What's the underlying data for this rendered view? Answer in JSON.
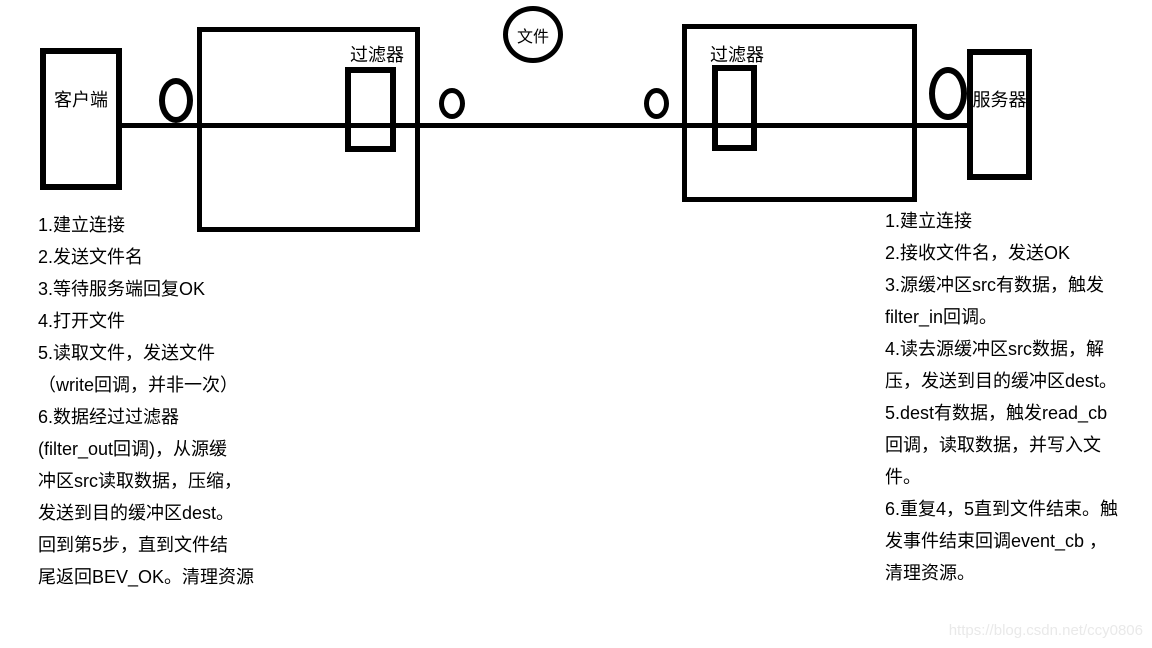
{
  "diagram": {
    "client_label": "客户端",
    "server_label": "服务器",
    "file_label": "文件",
    "filter_left_label": "过滤器",
    "filter_right_label": "过滤器",
    "client_steps": [
      "1.建立连接",
      "2.发送文件名",
      "3.等待服务端回复OK",
      "4.打开文件",
      "5.读取文件，发送文件",
      "（write回调，并非一次）",
      "6.数据经过过滤器",
      "(filter_out回调)，从源缓",
      "冲区src读取数据，压缩，",
      "发送到目的缓冲区dest。",
      "回到第5步，直到文件结",
      "尾返回BEV_OK。清理资源"
    ],
    "server_steps": [
      "1.建立连接",
      "2.接收文件名，发送OK",
      "3.源缓冲区src有数据，触发",
      "filter_in回调。",
      "4.读去源缓冲区src数据，解",
      "压，发送到目的缓冲区dest。",
      "5.dest有数据，触发read_cb",
      "回调，读取数据，并写入文",
      "件。",
      "6.重复4，5直到文件结束。触",
      "发事件结束回调event_cb ，",
      "清理资源。"
    ],
    "colors": {
      "stroke": "#000000",
      "background": "#ffffff"
    }
  },
  "watermark": {
    "text": "https://blog.csdn.net/ccy0806",
    "color": "#e9e9e9"
  }
}
